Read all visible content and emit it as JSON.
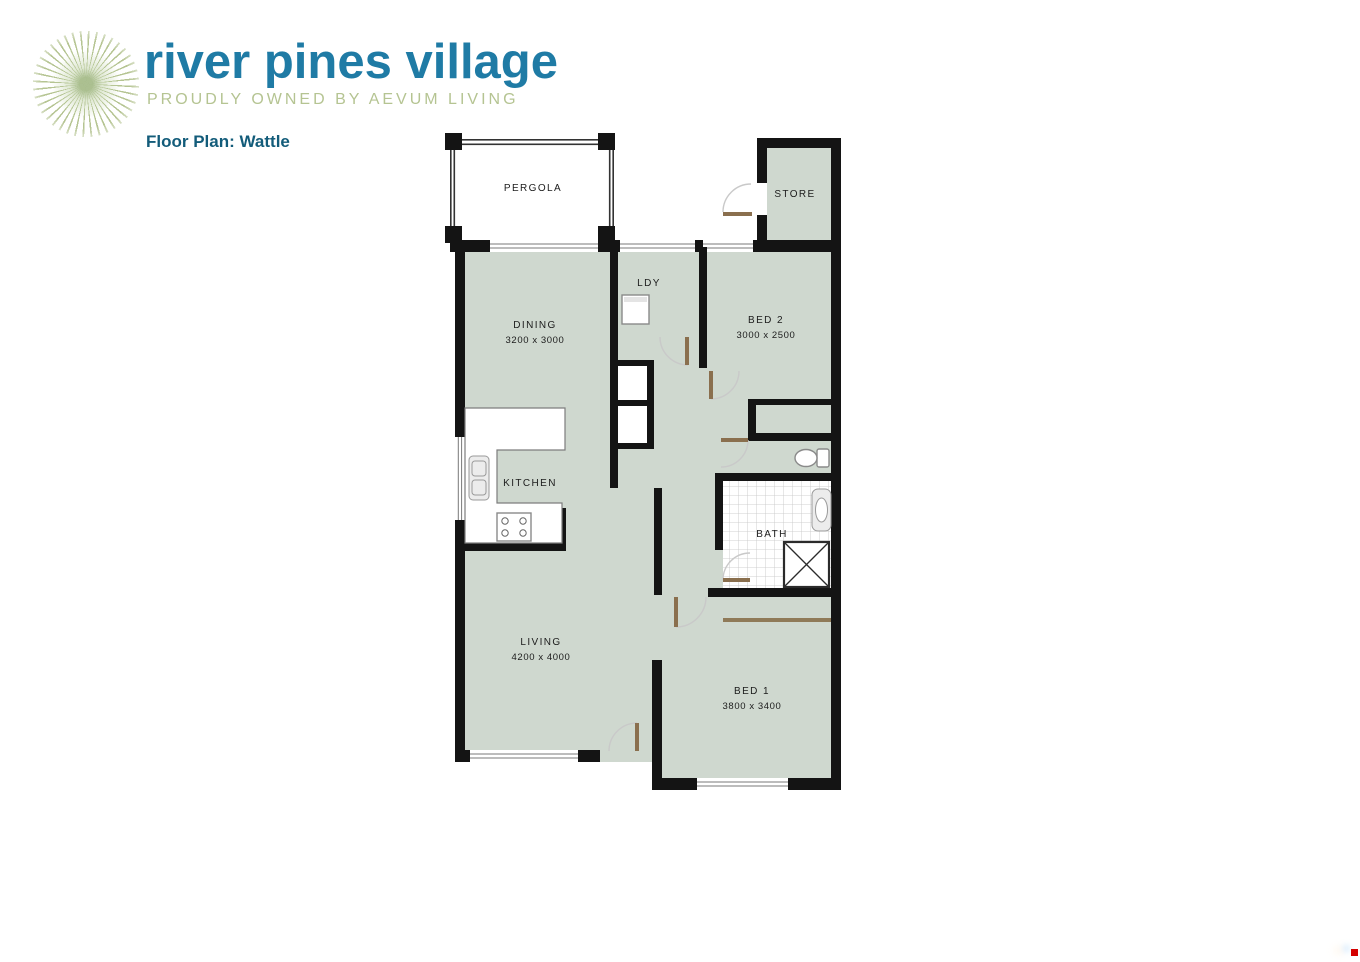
{
  "header": {
    "brand": "river pines village",
    "tagline": "PROUDLY OWNED BY AEVUM LIVING",
    "logo": "starburst-icon"
  },
  "page": {
    "title": "Floor Plan: Wattle"
  },
  "colors": {
    "brand_teal": "#1f7ba5",
    "brand_green": "#b5c492",
    "title_teal": "#135c7a",
    "floor": "#cfd8cf",
    "wall": "#141414",
    "door_leaf": "#8a6f4e",
    "swing_arc": "#c9c9c9",
    "marker_red": "#d40000"
  },
  "plan": {
    "rooms": {
      "pergola": {
        "label": "PERGOLA"
      },
      "store": {
        "label": "STORE"
      },
      "laundry": {
        "label": "LDY"
      },
      "dining": {
        "label": "DINING",
        "dimensions": "3200 x 3000"
      },
      "bed2": {
        "label": "BED 2",
        "dimensions": "3000 x 2500"
      },
      "kitchen": {
        "label": "KITCHEN"
      },
      "bath": {
        "label": "BATH"
      },
      "living": {
        "label": "LIVING",
        "dimensions": "4200 x 4000"
      },
      "bed1": {
        "label": "BED 1",
        "dimensions": "3800 x 3400"
      }
    },
    "fixtures": [
      "washing-machine",
      "sink",
      "stove",
      "toilet",
      "vanity-basin",
      "shower",
      "robe"
    ]
  }
}
